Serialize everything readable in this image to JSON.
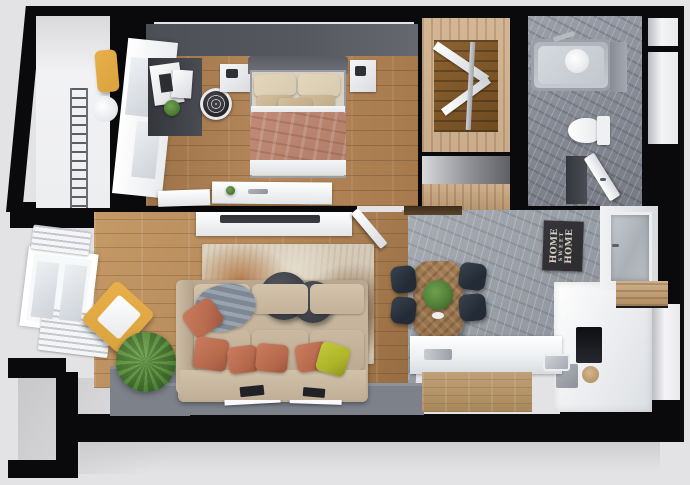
{
  "poster": {
    "line1": "HOME",
    "line2": "SWEET",
    "line3": "HOME"
  },
  "colors": {
    "background": "#e3e3e5",
    "wall": "#0a0a0c",
    "wood_a": "#b5885a",
    "wood_b": "#9c7248",
    "dark_wall": "#55585e",
    "concrete": "#9aa0a8",
    "tile": "#878b95",
    "platform": "#7c818a",
    "white": "#f1f2f4",
    "sofa": "#c7b69e",
    "pillow": "#b86a4e",
    "pillow_accent": "#aeb528",
    "blanket": "#b27e6a",
    "bed_linen": "#d8cbb0",
    "chair_yellow": "#daa23d",
    "chair_dark": "#232c36",
    "table_wood": "#96714a",
    "closet_wood": "#c9ac8b",
    "plant": "#4d7c36",
    "rug_base": "#d2c6b2",
    "tub": "#c6cbd2",
    "poster_bg": "#2d2d2f",
    "poster_text": "#d8d2c4",
    "tv": "#3a3c42"
  }
}
